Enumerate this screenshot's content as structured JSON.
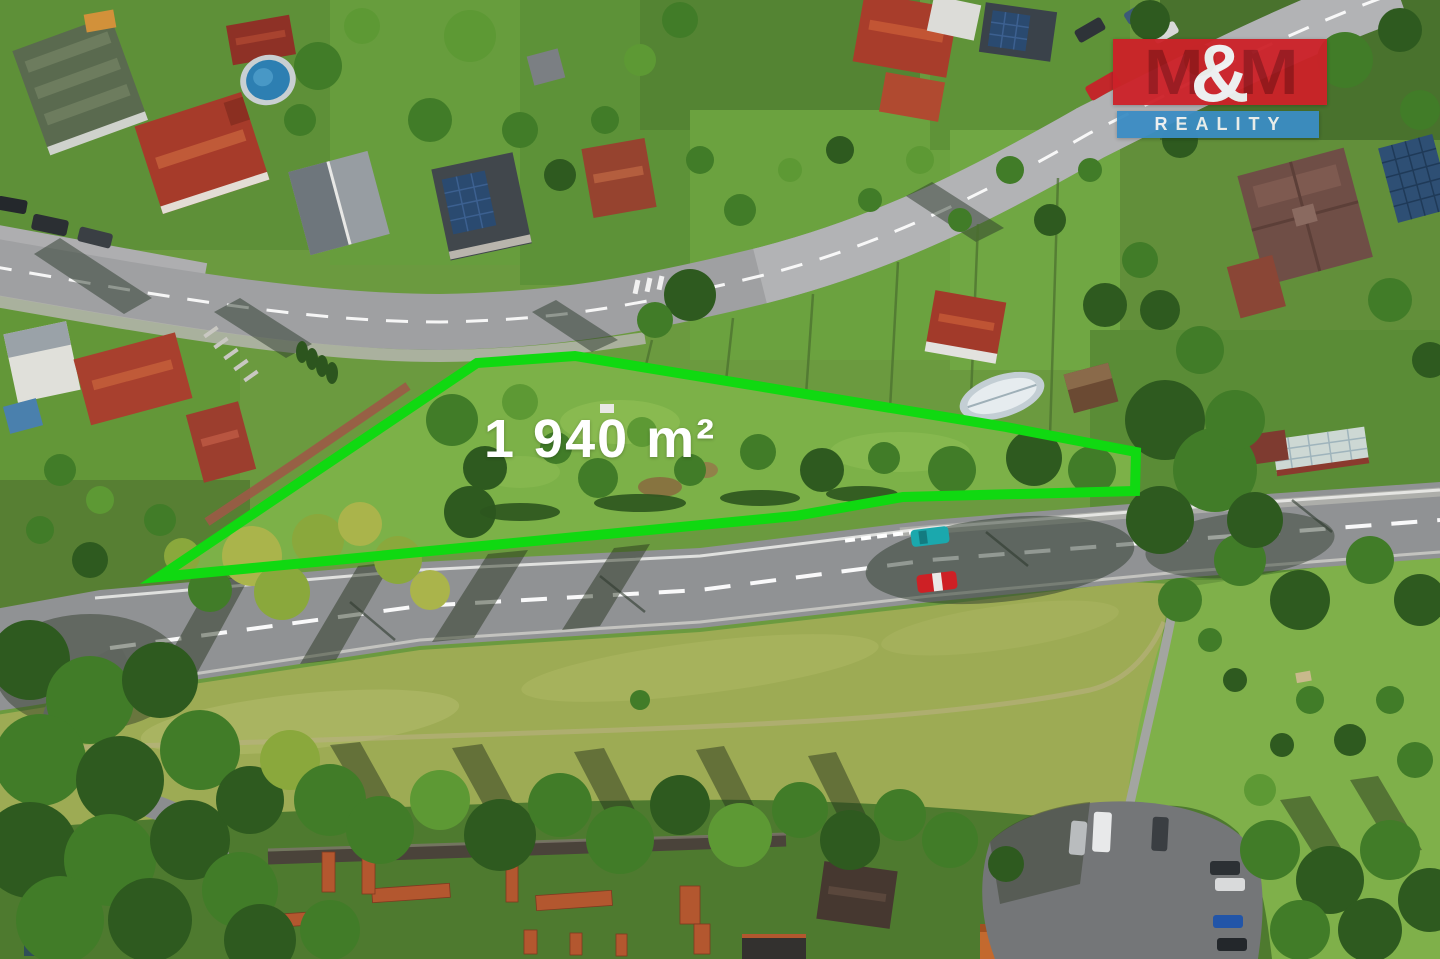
{
  "plot": {
    "area_label": "1 940 m²",
    "outline_color": "#10d911",
    "outline_points": "159,577 477,363 575,356 1006,427 1136,452 1135,491 903,497 795,516"
  },
  "watermark": {
    "m_left": "M",
    "ampersand": "&",
    "m_right": "M",
    "wordmark": "REALITY",
    "red_bg": "#cd2128",
    "m_color": "#9a151c",
    "blue_bg": "#3b8dc4",
    "text_color": "#f1f3f4"
  }
}
